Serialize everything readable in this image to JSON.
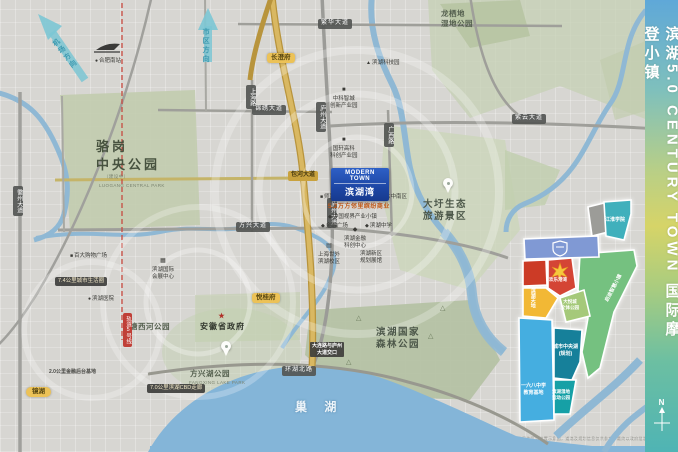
{
  "sidebar": {
    "title": "滨湖5.0 CENTURY TOWN 国际摩登小镇",
    "compass": "N"
  },
  "marker": {
    "en": "MODERN TOWN",
    "cn": "滨湖湾"
  },
  "icons": {
    "star": "★",
    "dot": "●",
    "sq": "■",
    "di": "◆",
    "school": "▤",
    "hall": "▦",
    "bld": "▲",
    "tree": "△",
    "train": "▭"
  },
  "panel": {
    "disclaimer": "本图为区域位置示意图，道路及规划信息仅供参考，最终以政府批准文件为准"
  },
  "labels": [
    {
      "cls": "park-lg",
      "x": 96,
      "y": 138,
      "lines": [
        "骆岗",
        "中央公园"
      ],
      "name": "label-luogang-park"
    },
    {
      "cls": "park-en",
      "x": 104,
      "y": 174,
      "lines": [
        "（建设中）"
      ],
      "name": "label-luogang-sub"
    },
    {
      "cls": "park-en",
      "x": 99,
      "y": 183,
      "lines": [
        "LUOGANG CENTRAL PARK"
      ],
      "name": "label-luogang-en"
    },
    {
      "cls": "park-md",
      "x": 423,
      "y": 199,
      "lines": [
        "大圩生态",
        "旅游景区"
      ],
      "name": "label-daxu-scenic"
    },
    {
      "cls": "park-md",
      "x": 376,
      "y": 327,
      "lines": [
        "滨湖国家",
        "森林公园"
      ],
      "name": "label-forest-park"
    },
    {
      "cls": "park-sm",
      "x": 441,
      "y": 9,
      "lines": [
        "龙栖地",
        "湿地公园"
      ],
      "name": "label-wetland-park"
    },
    {
      "cls": "park-sm",
      "x": 190,
      "y": 369,
      "lines": [
        "方兴湖公园"
      ],
      "name": "label-fangxing-park"
    },
    {
      "cls": "park-en",
      "x": 189,
      "y": 380,
      "lines": [
        "FANGXING LAKE PARK"
      ],
      "name": "label-fangxing-en"
    },
    {
      "cls": "park-sm",
      "x": 130,
      "y": 322,
      "lines": [
        "塘西河公园"
      ],
      "name": "label-tangxihe-park"
    },
    {
      "cls": "gov",
      "x": 200,
      "y": 312,
      "lines": [
        "安徽省政府"
      ],
      "icon": "star",
      "name": "label-gov"
    },
    {
      "cls": "lake-lbl",
      "x": 295,
      "y": 400,
      "lines": [
        "巢 湖"
      ],
      "name": "label-chaohu-lake"
    },
    {
      "cls": "poi",
      "x": 95,
      "y": 58,
      "lines": [
        "合肥南站"
      ],
      "icon": "dot",
      "name": "label-hefei-south-station"
    },
    {
      "cls": "dir dir1",
      "x": 60,
      "y": 36,
      "lines": [
        "机场方向"
      ],
      "name": "label-dir-airport"
    },
    {
      "cls": "dir",
      "x": 201,
      "y": 28,
      "lines": [
        "市区方向"
      ],
      "name": "label-dir-city"
    },
    {
      "cls": "rbadge",
      "x": 318,
      "y": 19,
      "lines": [
        "繁华大道"
      ]
    },
    {
      "cls": "rbadge",
      "x": 252,
      "y": 105,
      "lines": [
        "锦绣大道"
      ]
    },
    {
      "cls": "rbadge",
      "x": 236,
      "y": 222,
      "lines": [
        "方兴大道"
      ]
    },
    {
      "cls": "rbadge",
      "x": 282,
      "y": 366,
      "lines": [
        "环湖北路"
      ]
    },
    {
      "cls": "rbadge",
      "x": 512,
      "y": 114,
      "lines": [
        "紫云大道"
      ]
    },
    {
      "cls": "rbadge v",
      "x": 246,
      "y": 85,
      "lines": [
        "上海路"
      ]
    },
    {
      "cls": "rbadge v",
      "x": 316,
      "y": 102,
      "lines": [
        "庐州大道"
      ]
    },
    {
      "cls": "rbadge v",
      "x": 327,
      "y": 198,
      "lines": [
        "庐州大道"
      ]
    },
    {
      "cls": "rbadge v",
      "x": 384,
      "y": 123,
      "lines": [
        "广西路"
      ]
    },
    {
      "cls": "rbadge v",
      "x": 13,
      "y": 186,
      "lines": [
        "徽州大道"
      ]
    },
    {
      "cls": "gbadge",
      "x": 288,
      "y": 171,
      "lines": [
        "包河大道"
      ]
    },
    {
      "cls": "mbadge",
      "x": 123,
      "y": 313,
      "lines": [
        "轨道5号线"
      ]
    },
    {
      "cls": "ybadge",
      "x": 267,
      "y": 53,
      "lines": [
        "长澄府"
      ]
    },
    {
      "cls": "ybadge",
      "x": 252,
      "y": 293,
      "lines": [
        "悦桂府"
      ]
    },
    {
      "cls": "ybadge ellipse",
      "x": 26,
      "y": 387,
      "lines": [
        "镜湖"
      ]
    },
    {
      "cls": "dbadge",
      "x": 55,
      "y": 277,
      "lines": [
        "7.4公里城市生活圈"
      ]
    },
    {
      "cls": "dbadge",
      "x": 147,
      "y": 384,
      "lines": [
        "7.0公里滨湖CBD走廊"
      ]
    },
    {
      "cls": "dsmall",
      "x": 49,
      "y": 369,
      "lines": [
        "2.0公里金融后台基地"
      ]
    },
    {
      "cls": "dsmall dark",
      "x": 310,
      "y": 342,
      "lines": [
        "大连路与庐州",
        "大道交口"
      ]
    },
    {
      "cls": "orange",
      "x": 328,
      "y": 204,
      "lines": [
        "5.2万方邻里缤纷商业"
      ]
    },
    {
      "cls": "poi",
      "x": 320,
      "y": 194,
      "lines": [
        "师范附属小学"
      ],
      "icon": "sq"
    },
    {
      "cls": "poi",
      "x": 370,
      "y": 194,
      "lines": [
        "四十六中南区"
      ],
      "icon": "sq"
    },
    {
      "cls": "poi",
      "x": 328,
      "y": 214,
      "lines": [
        "中国视界产业小镇"
      ],
      "icon": "di"
    },
    {
      "cls": "poi",
      "x": 321,
      "y": 223,
      "lines": [
        "金融广场"
      ],
      "icon": "di"
    },
    {
      "cls": "poi",
      "x": 365,
      "y": 223,
      "lines": [
        "滨湖中学"
      ],
      "icon": "di"
    },
    {
      "cls": "poi2",
      "x": 318,
      "y": 243,
      "lines": [
        "上海世外",
        "滨湖校区"
      ],
      "icon": "school"
    },
    {
      "cls": "poi2",
      "x": 360,
      "y": 251,
      "lines": [
        "滨湖新区",
        "规划展馆"
      ]
    },
    {
      "cls": "poi2",
      "x": 330,
      "y": 87,
      "lines": [
        "中科智城",
        "创新产业园"
      ],
      "icon": "sq"
    },
    {
      "cls": "poi2",
      "x": 330,
      "y": 137,
      "lines": [
        "国轩高科",
        "科创产业园"
      ],
      "icon": "sq"
    },
    {
      "cls": "poi2",
      "x": 344,
      "y": 227,
      "lines": [
        "滨湖金融",
        "科创中心"
      ],
      "icon": "di"
    },
    {
      "cls": "poi",
      "x": 70,
      "y": 253,
      "lines": [
        "百大购物广场"
      ],
      "icon": "sq"
    },
    {
      "cls": "poi",
      "x": 88,
      "y": 296,
      "lines": [
        "滨湖医院"
      ],
      "icon": "dot"
    },
    {
      "cls": "poi2",
      "x": 152,
      "y": 258,
      "lines": [
        "滨湖国际",
        "会展中心"
      ],
      "icon": "hall"
    },
    {
      "cls": "poi",
      "x": 366,
      "y": 60,
      "lines": [
        "滨湖科技园"
      ],
      "icon": "bld"
    },
    {
      "cls": "tree",
      "x": 356,
      "y": 314,
      "lines": [
        "△"
      ]
    },
    {
      "cls": "tree",
      "x": 428,
      "y": 332,
      "lines": [
        "△"
      ]
    },
    {
      "cls": "tree",
      "x": 346,
      "y": 358,
      "lines": [
        "△"
      ]
    },
    {
      "cls": "tree",
      "x": 440,
      "y": 304,
      "lines": [
        "△"
      ]
    },
    {
      "cls": "pb",
      "x": 605,
      "y": 217,
      "lines": [
        "江淮学院"
      ],
      "name": "panel-label-jianghuai"
    },
    {
      "cls": "pb rot",
      "x": 604,
      "y": 300,
      "lines": [
        "启迪智慧小镇"
      ],
      "name": "panel-label-smart-town"
    },
    {
      "cls": "pb t4",
      "x": 549,
      "y": 277,
      "lines": [
        "欢乐港湾"
      ],
      "name": "panel-label-joy-harbor"
    },
    {
      "cls": "pb vert",
      "x": 529,
      "y": 288,
      "lines": [
        "滨湖天地"
      ],
      "name": "panel-label-tiandi"
    },
    {
      "cls": "pb t4",
      "x": 561,
      "y": 299,
      "lines": [
        "大悦城",
        "文体公园"
      ],
      "name": "panel-label-wenti"
    },
    {
      "cls": "pb",
      "x": 521,
      "y": 383,
      "lines": [
        "一六八中学",
        "教育基地"
      ],
      "name": "panel-label-school168"
    },
    {
      "cls": "pb",
      "x": 553,
      "y": 344,
      "lines": [
        "城市中央湖",
        "(规划)"
      ],
      "name": "panel-label-central-lake"
    },
    {
      "cls": "pb t4",
      "x": 552,
      "y": 389,
      "lines": [
        "滨湖湿地",
        "运动公园"
      ],
      "name": "panel-label-sports-park"
    }
  ]
}
